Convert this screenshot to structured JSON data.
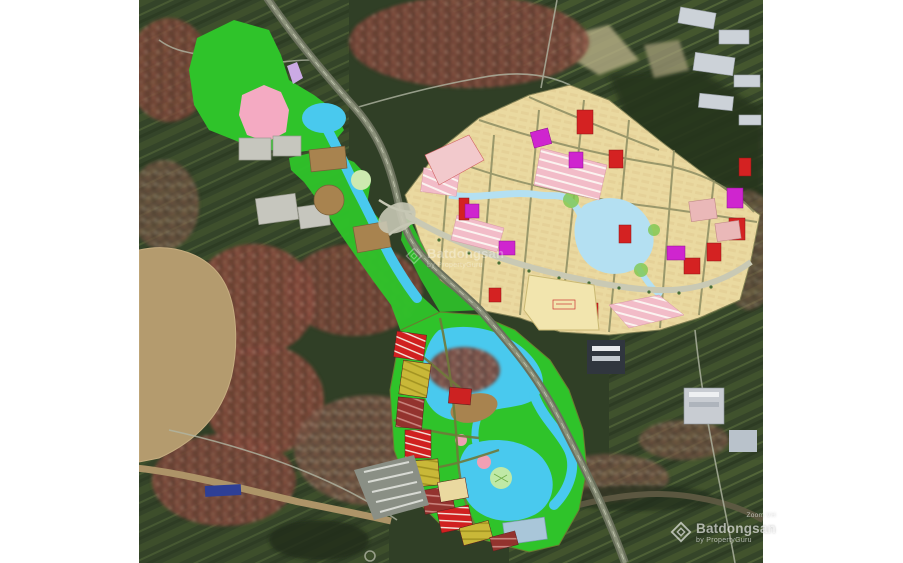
{
  "page": {
    "background": "#ffffff"
  },
  "watermarks": {
    "center": {
      "brand": "Batdongsan",
      "byline": "by PropertyGuru"
    },
    "corner": {
      "label": "Zoom VH",
      "brand": "Batdongsan",
      "byline": "by PropertyGuru"
    }
  },
  "map": {
    "type": "satellite-masterplan-overlay",
    "colors": {
      "satellite_dark": "#303f26",
      "park_green": "#2fc32a",
      "water_cyan": "#49c9ee",
      "lake_blue": "#b4e0f2",
      "plan_cream": "#ead9a0",
      "parcel_red": "#d42222",
      "parcel_magenta": "#cf25cf",
      "parcel_pink": "#f2bcc8",
      "parcel_rose": "#eab8b8",
      "parcel_olive": "#c9b838",
      "parcel_maroon": "#93332e",
      "soil_brown": "#a8834f",
      "river_tan": "#b49b6e",
      "zone_gray": "#c6c6be",
      "zone_pink": "#f4aac2",
      "zone_lavender": "#cbaae4",
      "block_bluegray": "#a9c6d9",
      "road_olive": "#8d8d62",
      "road_light": "#c9c9b4",
      "school_yellow": "#f2e5ae"
    }
  }
}
